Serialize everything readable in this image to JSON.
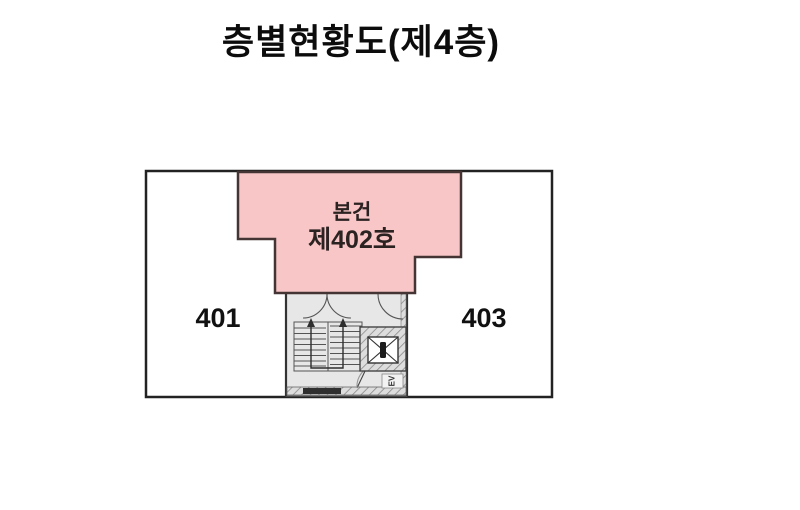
{
  "title": "층별현황도(제4층)",
  "plan": {
    "unit_left": "401",
    "unit_right": "403",
    "subject_unit": {
      "line1": "본건",
      "line2": "제402호"
    },
    "elevator_label": "EV",
    "colors": {
      "subject_fill": "#f8c6c6",
      "subject_stroke": "#453434",
      "outline": "#222222",
      "stairwell_bg": "#e7e7e7",
      "wall_line": "#555555",
      "text": "#111111",
      "background": "#ffffff"
    }
  }
}
